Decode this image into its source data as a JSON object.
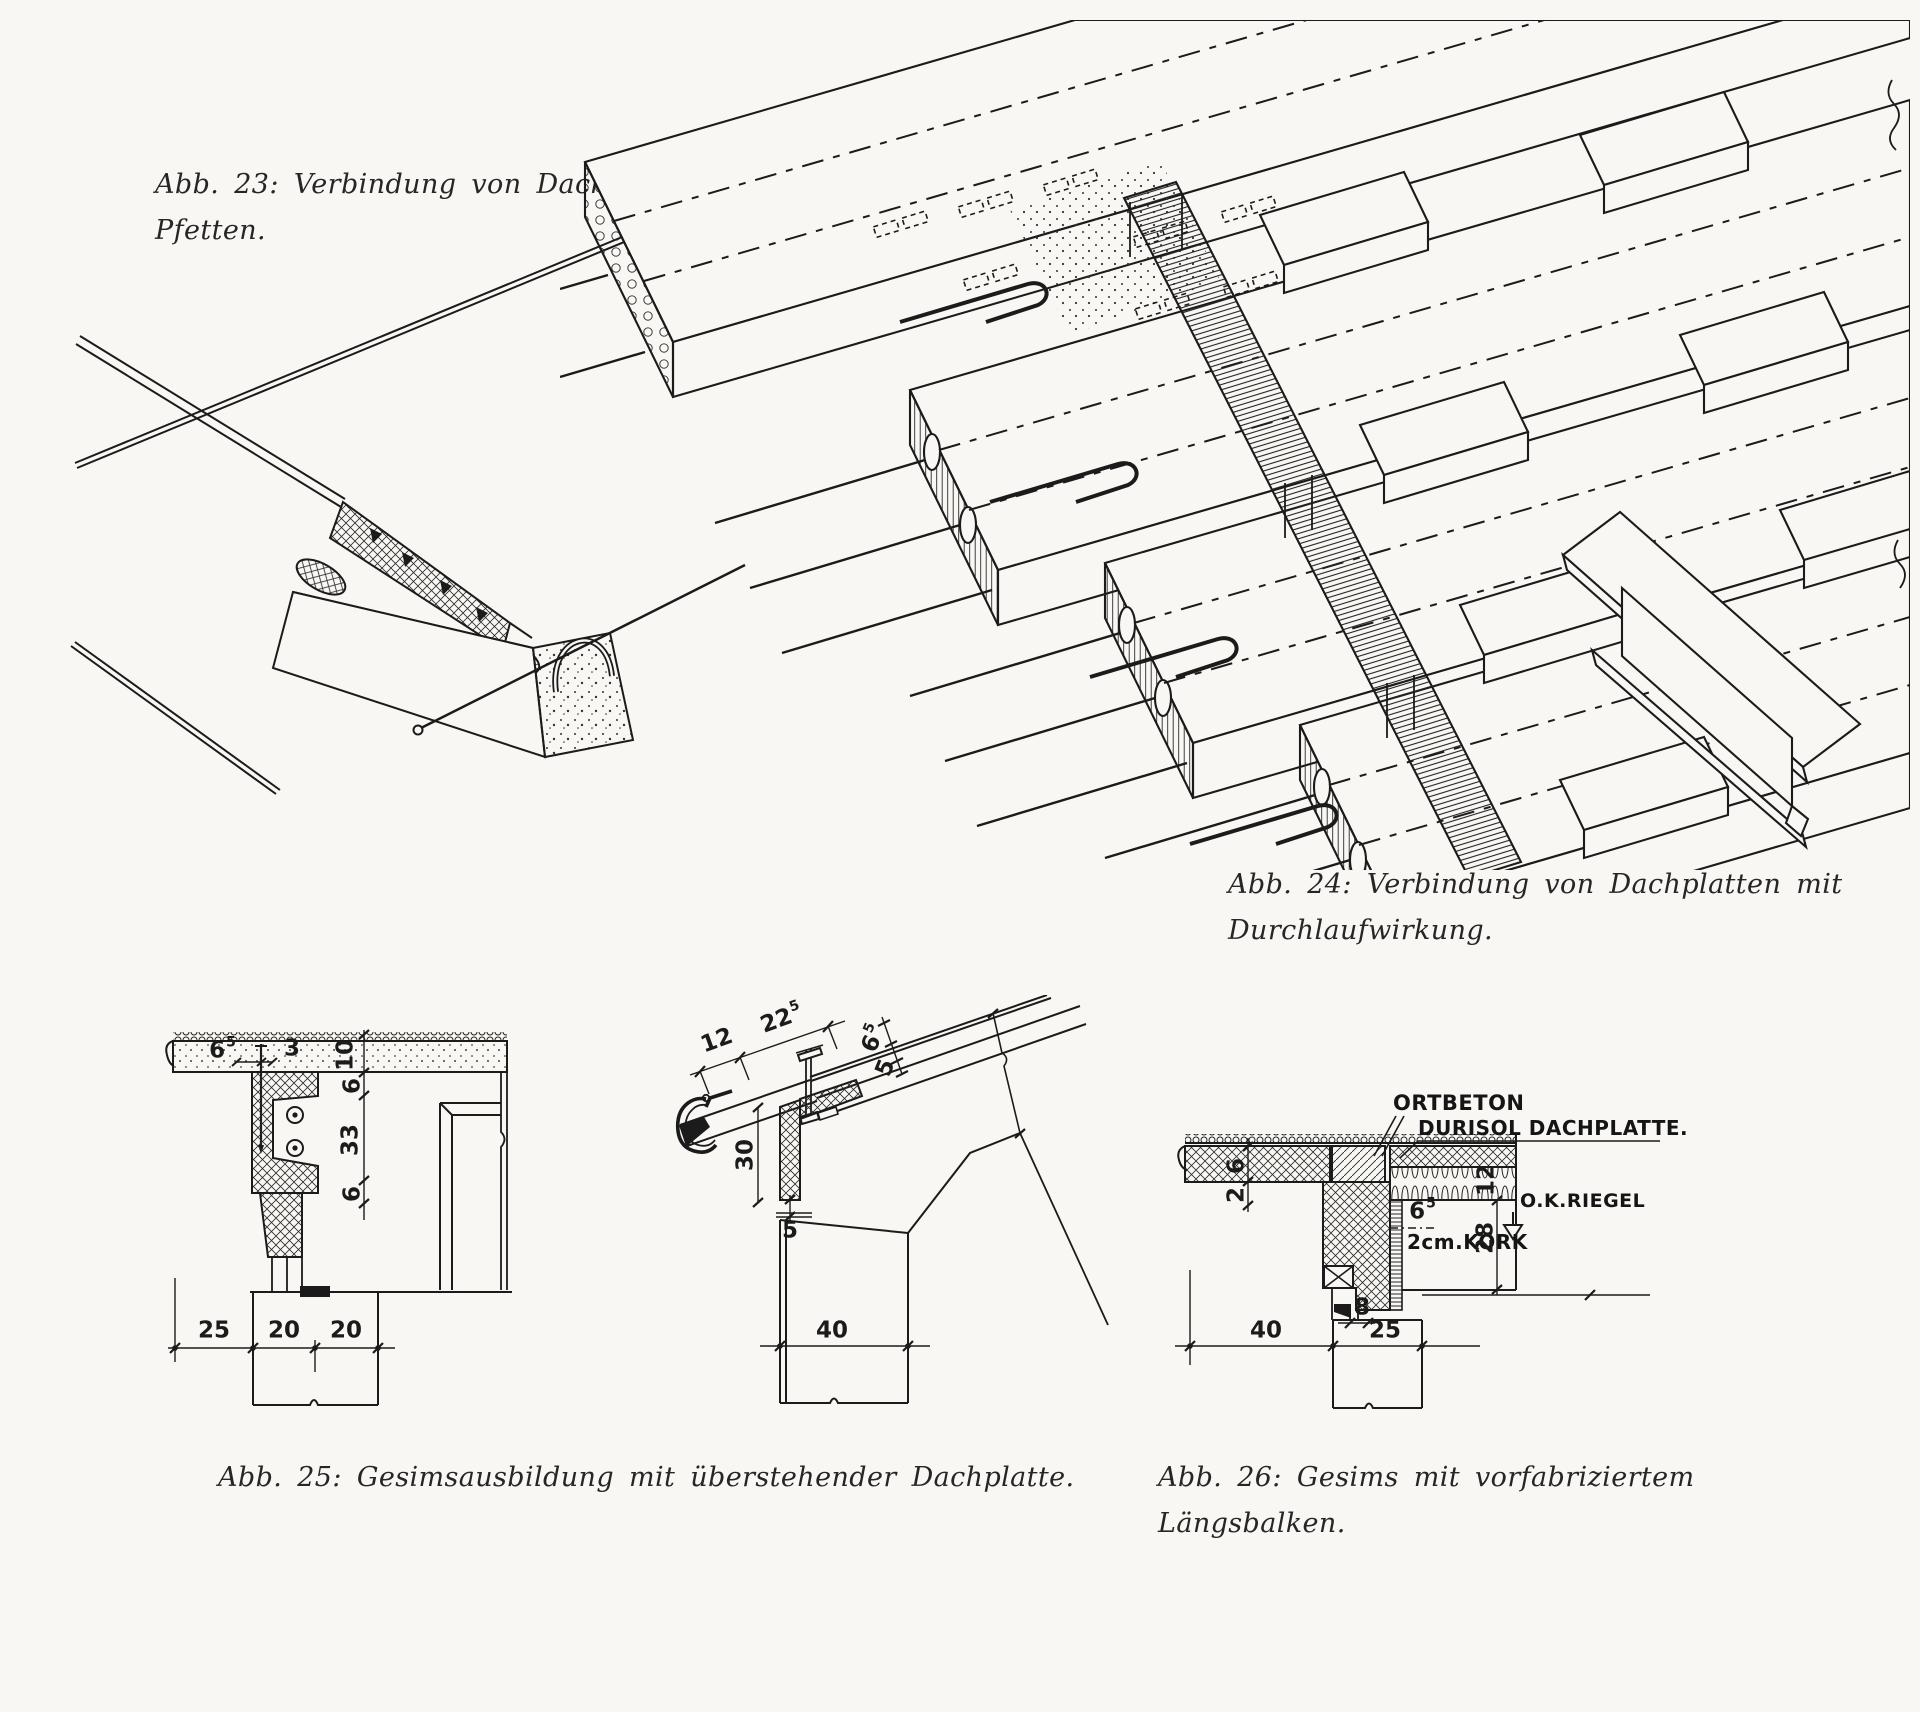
{
  "page": {
    "background": "#f8f7f3",
    "ink": "#1b1b1b"
  },
  "fig23": {
    "caption_l1": "Abb. 23: Verbindung von Dachplatten mit",
    "caption_l2": "Pfetten."
  },
  "fig24": {
    "caption_l1": "Abb. 24: Verbindung von Dachplatten mit",
    "caption_l2": "Durchlaufwirkung."
  },
  "fig25": {
    "caption": "Abb. 25: Gesimsausbildung mit überstehender Dachplatte.",
    "left_dims": {
      "d65_main": "6",
      "d65_sup": "5",
      "d3": "3",
      "d10": "10",
      "d6a": "6",
      "d33": "33",
      "d6b": "6",
      "d25": "25",
      "d20a": "20",
      "d20b": "20"
    },
    "right_dims": {
      "d12": "12",
      "d225_main": "22",
      "d225_sup": "5",
      "d65_main": "6",
      "d65_sup": "5",
      "d5a": "5",
      "d30": "30",
      "d5b": "5",
      "d40": "40"
    }
  },
  "fig26": {
    "caption_l1": "Abb. 26: Gesims mit vorfabriziertem",
    "caption_l2": "Längsbalken.",
    "labels": {
      "ortbeton": "ORTBETON",
      "dachplatte": "DURISOL DACHPLATTE.",
      "riegel": "O.K.RIEGEL",
      "kork": "2cm.KORK"
    },
    "dims": {
      "d6": "6",
      "d2": "2",
      "d65_main": "6",
      "d65_sup": "5",
      "d12": "12",
      "d28": "28",
      "d40": "40",
      "d8": "8",
      "d25": "25"
    }
  }
}
